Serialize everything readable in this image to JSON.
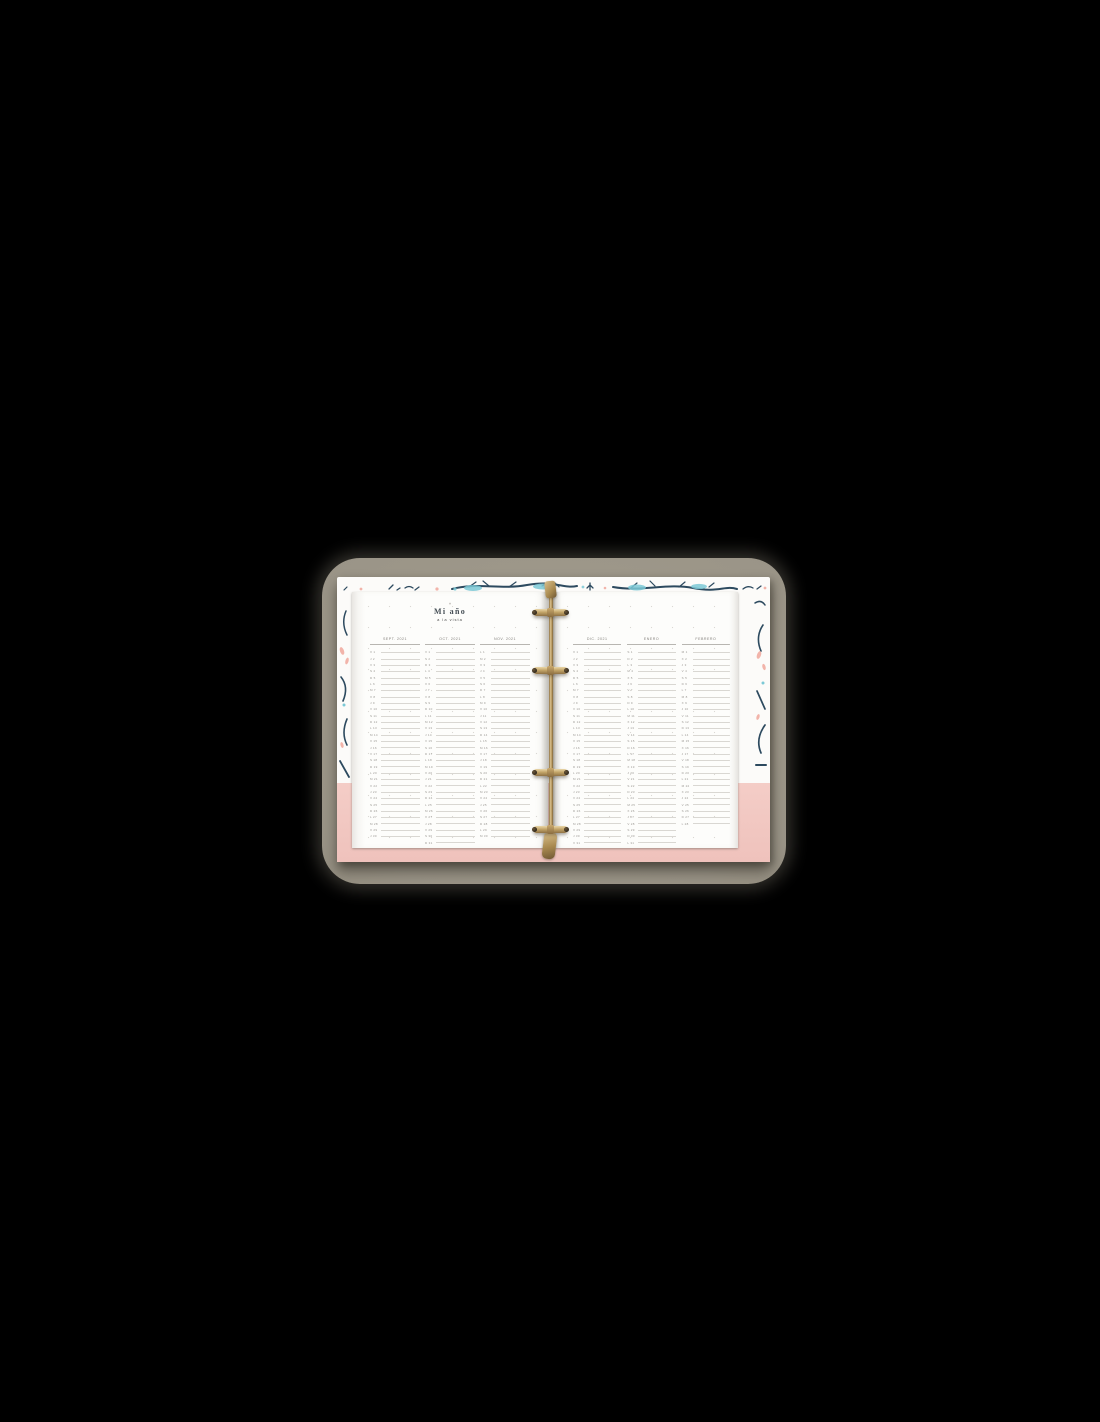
{
  "photo": {
    "heart_icon": "♥",
    "title": "Mi año",
    "subtitle": "a la vista"
  },
  "colors": {
    "background": "#000000",
    "mat_khaki": "#9a9487",
    "cover_white": "#fcfbf9",
    "cover_pink": "#f4cdc7",
    "pattern_navy": "#2d4a5f",
    "pattern_teal": "#7cc9d6",
    "pattern_blush": "#f2b4aa",
    "ring_gold": "#b5965e",
    "page_white": "#fdfdfb",
    "title_ink": "#454e55",
    "header_gray": "#85827d",
    "line_gray": "#d9d7d2"
  },
  "months": [
    {
      "label": "SEPT. 2021",
      "side": "left",
      "days": [
        "X 1",
        "J 2",
        "V 3",
        "S 4",
        "D 5",
        "L 6",
        "M 7",
        "X 8",
        "J 9",
        "V 10",
        "S 11",
        "D 12",
        "L 13",
        "M 14",
        "X 15",
        "J 16",
        "V 17",
        "S 18",
        "D 19",
        "L 20",
        "M 21",
        "X 22",
        "J 23",
        "V 24",
        "S 25",
        "D 26",
        "L 27",
        "M 28",
        "X 29",
        "J 30"
      ]
    },
    {
      "label": "OCT. 2021",
      "side": "left",
      "days": [
        "V 1",
        "S 2",
        "D 3",
        "L 4",
        "M 5",
        "X 6",
        "J 7",
        "V 8",
        "S 9",
        "D 10",
        "L 11",
        "M 12",
        "X 13",
        "J 14",
        "V 15",
        "S 16",
        "D 17",
        "L 18",
        "M 19",
        "X 20",
        "J 21",
        "V 22",
        "S 23",
        "D 24",
        "L 25",
        "M 26",
        "X 27",
        "J 28",
        "V 29",
        "S 30",
        "D 31"
      ]
    },
    {
      "label": "NOV. 2021",
      "side": "left",
      "days": [
        "L 1",
        "M 2",
        "X 3",
        "J 4",
        "V 5",
        "S 6",
        "D 7",
        "L 8",
        "M 9",
        "X 10",
        "J 11",
        "V 12",
        "S 13",
        "D 14",
        "L 15",
        "M 16",
        "X 17",
        "J 18",
        "V 19",
        "S 20",
        "D 21",
        "L 22",
        "M 23",
        "X 24",
        "J 25",
        "V 26",
        "S 27",
        "D 28",
        "L 29",
        "M 30"
      ]
    },
    {
      "label": "DIC. 2021",
      "side": "right",
      "days": [
        "X 1",
        "J 2",
        "V 3",
        "S 4",
        "D 5",
        "L 6",
        "M 7",
        "X 8",
        "J 9",
        "V 10",
        "S 11",
        "D 12",
        "L 13",
        "M 14",
        "X 15",
        "J 16",
        "V 17",
        "S 18",
        "D 19",
        "L 20",
        "M 21",
        "X 22",
        "J 23",
        "V 24",
        "S 25",
        "D 26",
        "L 27",
        "M 28",
        "X 29",
        "J 30",
        "V 31"
      ]
    },
    {
      "label": "ENERO",
      "side": "right",
      "days": [
        "S 1",
        "D 2",
        "L 3",
        "M 4",
        "X 5",
        "J 6",
        "V 7",
        "S 8",
        "D 9",
        "L 10",
        "M 11",
        "X 12",
        "J 13",
        "V 14",
        "S 15",
        "D 16",
        "L 17",
        "M 18",
        "X 19",
        "J 20",
        "V 21",
        "S 22",
        "D 23",
        "L 24",
        "M 25",
        "X 26",
        "J 27",
        "V 28",
        "S 29",
        "D 30",
        "L 31"
      ]
    },
    {
      "label": "FEBRERO",
      "side": "right",
      "days": [
        "M 1",
        "X 2",
        "J 3",
        "V 4",
        "S 5",
        "D 6",
        "L 7",
        "M 8",
        "X 9",
        "J 10",
        "V 11",
        "S 12",
        "D 13",
        "L 14",
        "M 15",
        "X 16",
        "J 17",
        "V 18",
        "S 19",
        "D 20",
        "L 21",
        "M 22",
        "X 23",
        "J 24",
        "V 25",
        "S 26",
        "D 27",
        "L 28"
      ]
    }
  ]
}
